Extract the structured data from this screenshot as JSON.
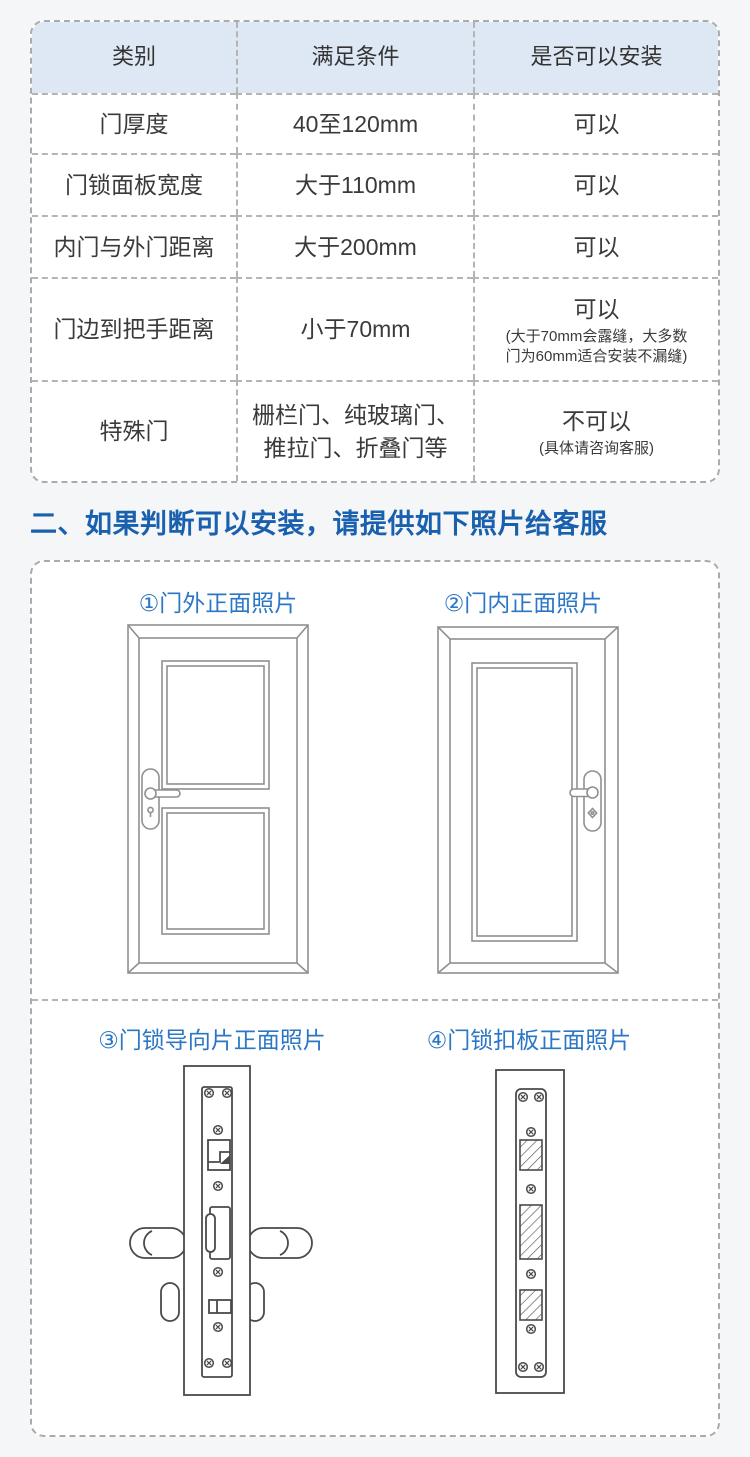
{
  "table": {
    "headers": [
      "类别",
      "满足条件",
      "是否可以安装"
    ],
    "rows": [
      {
        "category": "门厚度",
        "condition": "40至120mm",
        "result": "可以",
        "note": ""
      },
      {
        "category": "门锁面板宽度",
        "condition": "大于110mm",
        "result": "可以",
        "note": ""
      },
      {
        "category": "内门与外门距离",
        "condition": "大于200mm",
        "result": "可以",
        "note": ""
      },
      {
        "category": "门边到把手距离",
        "condition": "小于70mm",
        "result": "可以",
        "note": "(大于70mm会露缝，大多数\n门为60mm适合安装不漏缝)"
      },
      {
        "category": "特殊门",
        "condition": "栅栏门、纯玻璃门、\n推拉门、折叠门等",
        "result": "不可以",
        "note": "(具体请咨询客服)"
      }
    ]
  },
  "section_heading": "二、如果判断可以安装，请提供如下照片给客服",
  "photo_guide": {
    "labels": [
      "①门外正面照片",
      "②门内正面照片",
      "③门锁导向片正面照片",
      "④门锁扣板正面照片"
    ]
  },
  "colors": {
    "heading_blue": "#1961ae",
    "label_blue": "#2b77c5",
    "table_header_bg": "#dde8f4",
    "dash_gray": "#ababab",
    "page_bg": "#f5f6f7"
  }
}
